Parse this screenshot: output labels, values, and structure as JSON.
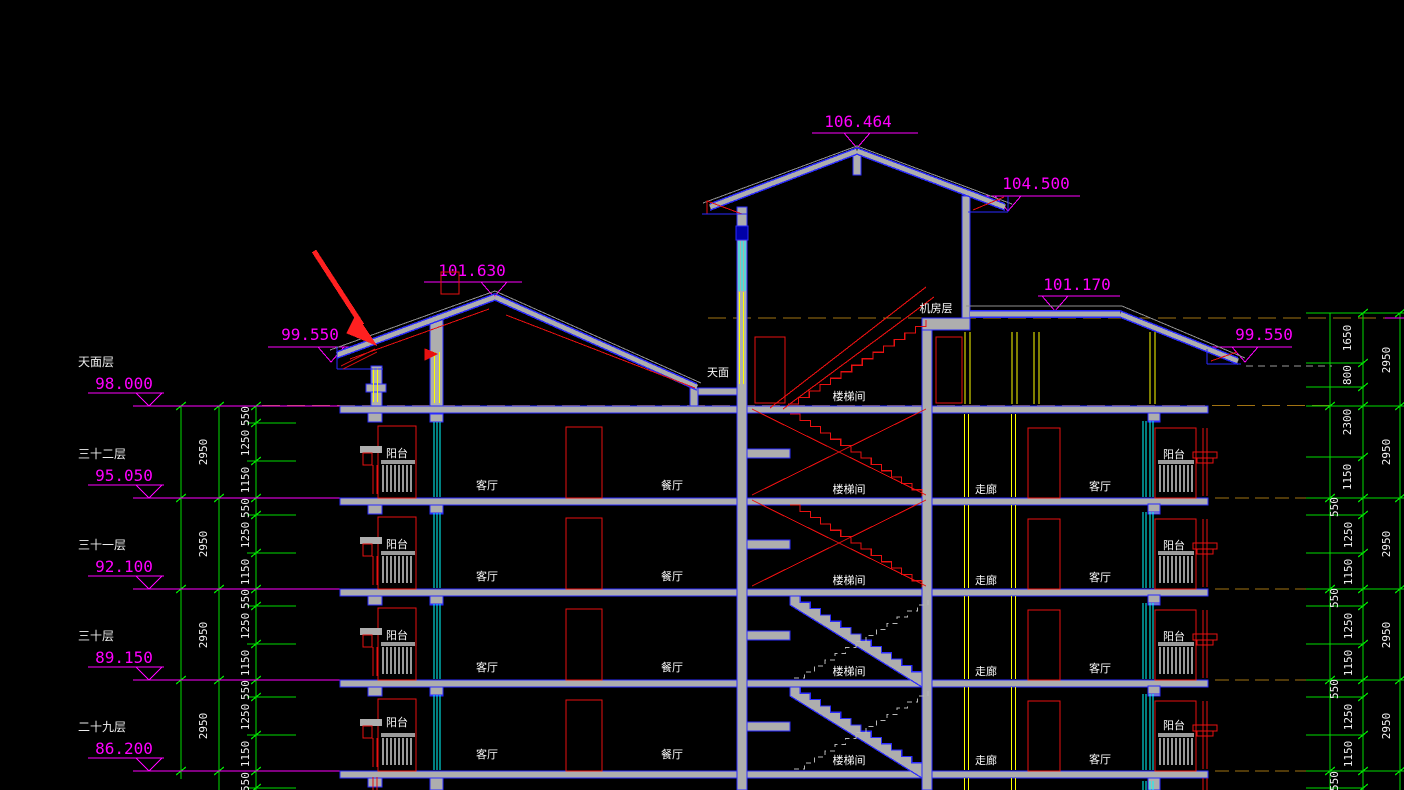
{
  "drawing": {
    "title": "residential building section (CAD)",
    "colors": {
      "bg": "#000000",
      "blue": "#2a2aff",
      "gray_fill": "#aeaeae",
      "gray_line": "#8f8f8f",
      "magenta": "#ff00ff",
      "green": "#00dd00",
      "red": "#e81010",
      "arrow_red": "#ff2020",
      "yellow": "#ffff00",
      "cyan": "#00ffff",
      "orange": "#a27312",
      "white": "#f2f2f2",
      "dark_blue": "#0000a8"
    },
    "roof_elevations": [
      {
        "label": "106.464",
        "tx": 858,
        "ty": 127,
        "lx1": 812,
        "lx2": 918,
        "ly": 133,
        "ax": 857
      },
      {
        "label": "104.500",
        "tx": 1036,
        "ty": 189,
        "lx1": 985,
        "lx2": 1080,
        "ly": 196,
        "ax": 1008
      },
      {
        "label": "101.630",
        "tx": 472,
        "ty": 276,
        "lx1": 424,
        "lx2": 522,
        "ly": 282,
        "ax": 494
      },
      {
        "label": "99.550",
        "tx": 310,
        "ty": 340,
        "lx1": 268,
        "lx2": 350,
        "ly": 347,
        "ax": 331
      },
      {
        "label": "101.170",
        "tx": 1077,
        "ty": 290,
        "lx1": 1038,
        "lx2": 1120,
        "ly": 296,
        "ax": 1055
      },
      {
        "label": "99.550",
        "tx": 1264,
        "ty": 340,
        "lx1": 1206,
        "lx2": 1292,
        "ly": 347,
        "ax": 1245
      }
    ],
    "floor_levels": [
      {
        "name": "天面层",
        "value": "98.000",
        "y": 406
      },
      {
        "name": "三十二层",
        "value": "95.050",
        "y": 498
      },
      {
        "name": "三十一层",
        "value": "92.100",
        "y": 589
      },
      {
        "name": "三十层",
        "value": "89.150",
        "y": 680
      },
      {
        "name": "二十九层",
        "value": "86.200",
        "y": 771
      }
    ],
    "room_labels": [
      {
        "text": "天面",
        "x": 718,
        "y": 376
      },
      {
        "text": "机房层",
        "x": 936,
        "y": 312
      },
      {
        "text": "楼梯间",
        "x": 849,
        "y": 400
      },
      {
        "text": "阳台",
        "x": 397,
        "y": 457
      },
      {
        "text": "客厅",
        "x": 487,
        "y": 489
      },
      {
        "text": "餐厅",
        "x": 672,
        "y": 489
      },
      {
        "text": "楼梯间",
        "x": 849,
        "y": 493
      },
      {
        "text": "走廊",
        "x": 986,
        "y": 493
      },
      {
        "text": "客厅",
        "x": 1100,
        "y": 490
      },
      {
        "text": "阳台",
        "x": 1174,
        "y": 458
      },
      {
        "text": "阳台",
        "x": 397,
        "y": 548
      },
      {
        "text": "客厅",
        "x": 487,
        "y": 580
      },
      {
        "text": "餐厅",
        "x": 672,
        "y": 580
      },
      {
        "text": "楼梯间",
        "x": 849,
        "y": 584
      },
      {
        "text": "走廊",
        "x": 986,
        "y": 584
      },
      {
        "text": "客厅",
        "x": 1100,
        "y": 581
      },
      {
        "text": "阳台",
        "x": 1174,
        "y": 549
      },
      {
        "text": "阳台",
        "x": 397,
        "y": 639
      },
      {
        "text": "客厅",
        "x": 487,
        "y": 671
      },
      {
        "text": "餐厅",
        "x": 672,
        "y": 671
      },
      {
        "text": "楼梯间",
        "x": 849,
        "y": 675
      },
      {
        "text": "走廊",
        "x": 986,
        "y": 675
      },
      {
        "text": "客厅",
        "x": 1100,
        "y": 672
      },
      {
        "text": "阳台",
        "x": 1174,
        "y": 640
      },
      {
        "text": "阳台",
        "x": 397,
        "y": 726
      },
      {
        "text": "客厅",
        "x": 487,
        "y": 758
      },
      {
        "text": "餐厅",
        "x": 672,
        "y": 758
      },
      {
        "text": "楼梯间",
        "x": 849,
        "y": 764
      },
      {
        "text": "走廊",
        "x": 986,
        "y": 764
      },
      {
        "text": "客厅",
        "x": 1100,
        "y": 763
      },
      {
        "text": "阳台",
        "x": 1174,
        "y": 729
      }
    ],
    "dims_left": {
      "overall": [
        "2950",
        "2950",
        "2950",
        "2950"
      ],
      "per_floor": [
        "550",
        "1250",
        "1150"
      ],
      "partial_bottom": "550"
    },
    "dims_right": {
      "top": [
        "1650",
        "800",
        "2300",
        "1150"
      ],
      "overall": [
        "2950",
        "2950",
        "2950",
        "2950",
        "2950"
      ],
      "per_floor": [
        "550",
        "1250",
        "1150"
      ],
      "partial_bottom": "550"
    }
  }
}
